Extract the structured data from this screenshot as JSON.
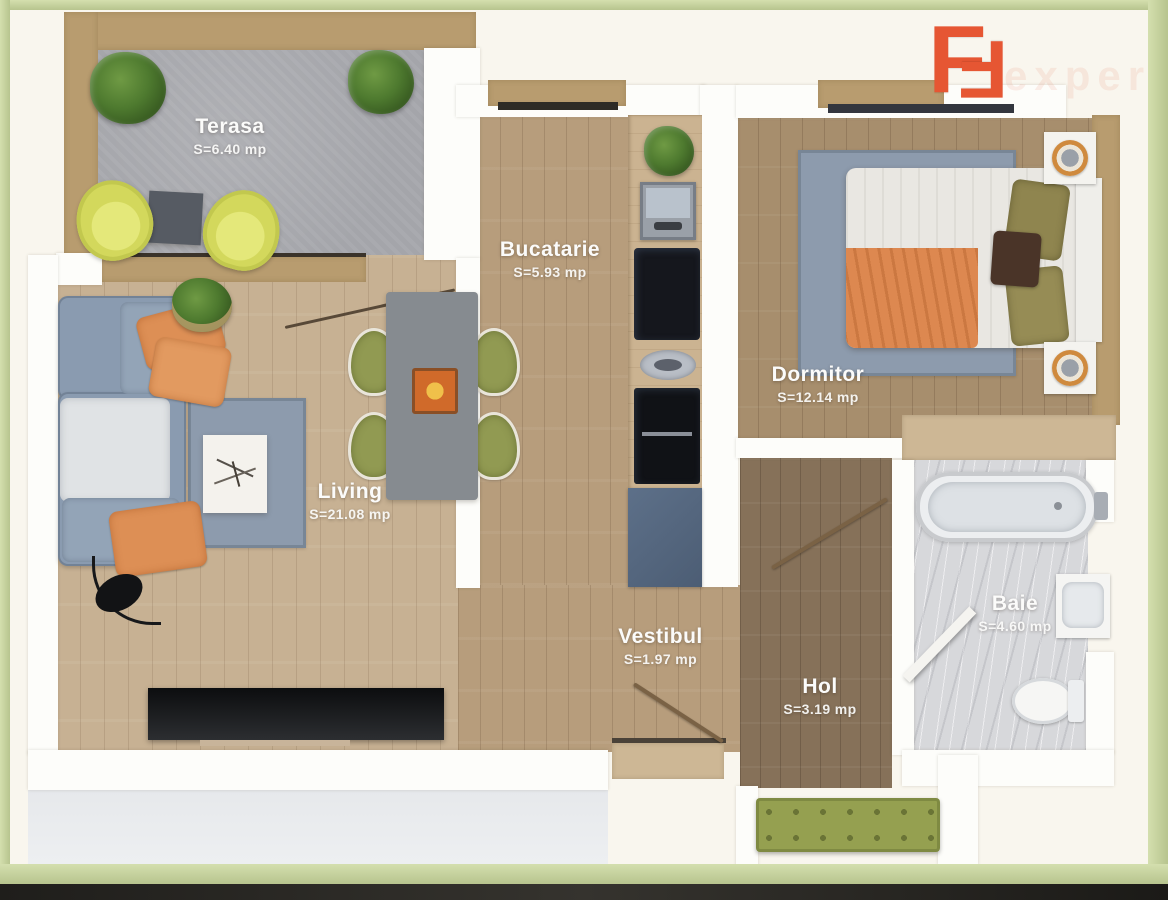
{
  "plan": {
    "rooms": {
      "terasa": {
        "label": "Terasa",
        "area": "S=6.40 mp"
      },
      "bucatarie": {
        "label": "Bucatarie",
        "area": "S=5.93 mp"
      },
      "dormitor": {
        "label": "Dormitor",
        "area": "S=12.14 mp"
      },
      "living": {
        "label": "Living",
        "area": "S=21.08 mp"
      },
      "vestibul": {
        "label": "Vestibul",
        "area": "S=1.97 mp"
      },
      "hol": {
        "label": "Hol",
        "area": "S=3.19 mp"
      },
      "baie": {
        "label": "Baie",
        "area": "S=4.60 mp"
      }
    }
  },
  "logo": {
    "letter_left": "F",
    "letter_right": "F",
    "watermark": "expert"
  },
  "colors": {
    "frame_green": "#c6d2a0",
    "background_cream": "#f9f6ee",
    "wall_white": "#fdfdfa",
    "wall_tan": "#b89c6f",
    "floor_living": "#c7b193",
    "floor_bedroom": "#a78e6d",
    "floor_hall": "#867159",
    "floor_terrace": "#a4a5aa",
    "floor_bath_marble": "#d7d8db",
    "logo_orange": "#e65633",
    "accent_orange_textile": "#dd8f55",
    "olive_green": "#919a52",
    "sofa_blue_gray": "#8a9bb0"
  }
}
